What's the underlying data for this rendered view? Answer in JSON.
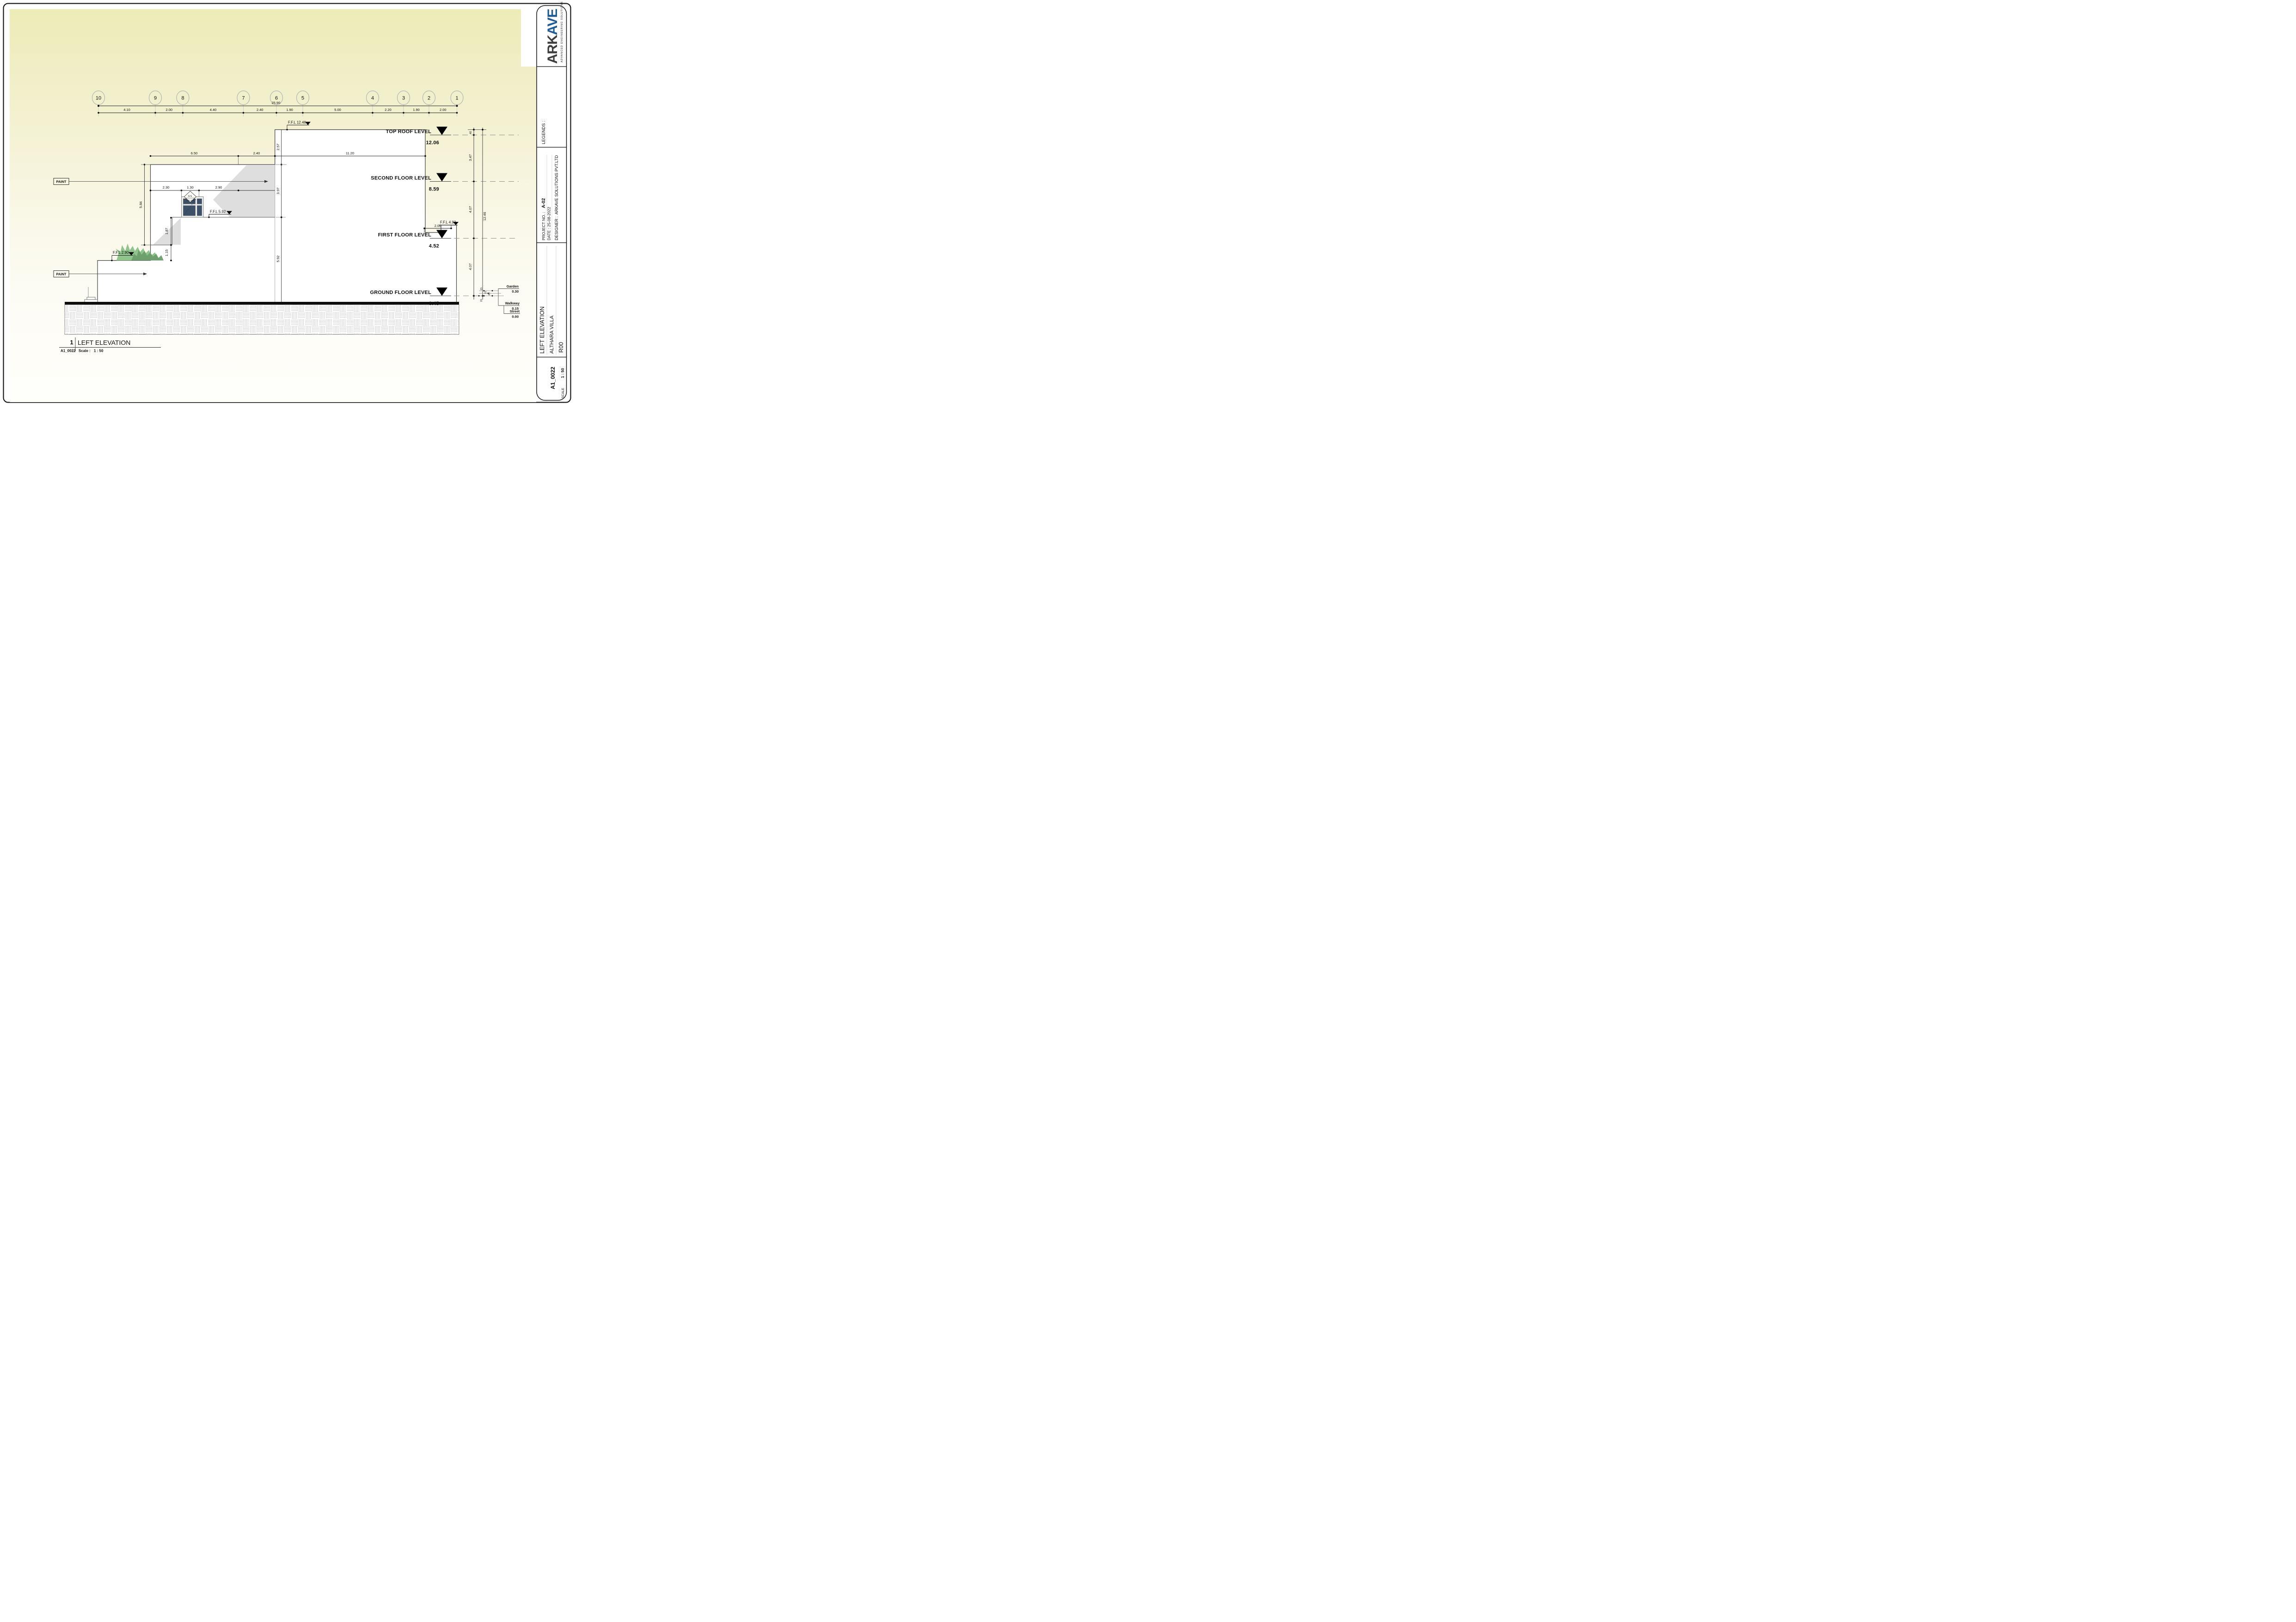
{
  "title_block": {
    "brand_prefix": "ARK",
    "brand_suffix": "AVE",
    "brand_tagline": "ADVANCED ENGINEERING SOLUTIONS",
    "legends_label": "LEGENDS :",
    "project_no_label": "PROJECT NO. :",
    "project_no_value": "A-02",
    "date_label": "DATE : 25-08-2022",
    "designer_label": "DESIGNER :",
    "designer_value": "ARKAVE SOLUTIONS PVT.LTD",
    "drawing_title": "LEFT ELEVATION",
    "project_name": "ALTHARA VILLA",
    "revision": "R00",
    "sheet_no": "A1_0022",
    "scale_label": "SCALE",
    "scale_value": "1 : 50"
  },
  "view_title": {
    "number": "1",
    "title": "LEFT ELEVATION",
    "sheet_ref": "A1_0022",
    "scale_label": "Scale :",
    "scale_value": "1 : 50"
  },
  "grid": {
    "bubbles": [
      "10",
      "9",
      "8",
      "7",
      "6",
      "5",
      "4",
      "3",
      "2",
      "1"
    ],
    "total": "25.90",
    "segments": [
      "4.10",
      "2.00",
      "4.40",
      "2.40",
      "1.90",
      "5.00",
      "2.20",
      "1.90",
      "2.00"
    ]
  },
  "levels": [
    {
      "name": "TOP ROOF LEVEL",
      "value": "12.06"
    },
    {
      "name": "SECOND FLOOR LEVEL",
      "value": "8.59"
    },
    {
      "name": "FIRST FLOOR LEVEL",
      "value": "4.52"
    },
    {
      "name": "GROUND FLOOR LEVEL",
      "value": "0.45"
    }
  ],
  "ffl": {
    "roof": "F.F.L 12.46",
    "second": "F.F.L 5.92",
    "garden": "F.F.L 2.90",
    "first": "F.F.L 4.92"
  },
  "site_levels": [
    {
      "name": "Garden",
      "value": "0.30"
    },
    {
      "name": "Walkway",
      "value": "0.15"
    },
    {
      "name": "Street",
      "value": "0.00"
    }
  ],
  "dims": {
    "roof_left": "6.50",
    "roof_left2": "2.40",
    "roof_main": "11.20",
    "left_height": "5.84",
    "step_height": "1.87",
    "planter_height": "1.15",
    "core_top": "2.57",
    "core_mid": "3.97",
    "core_bottom": "5.92",
    "parapet": "40",
    "roof_to_second": "3.47",
    "second_to_first": "4.07",
    "first_to_ground": "4.07",
    "overall_height": "12.46",
    "door_left": "2.30",
    "door_width": "1.30",
    "door_right": "2.90",
    "ledge_offset": "2.00",
    "site_small": [
      "15",
      "15",
      "45",
      "15"
    ]
  },
  "annotations": {
    "paint": "PAINT",
    "door_tag": "GS",
    "door_size": "1.30 x 3.00"
  },
  "colors": {
    "accent_blue": "#1d5c94",
    "logo_dark": "#3e3e3e",
    "door_panel": "#3c5168",
    "plant_light": "#8fc48c",
    "plant_dark": "#6d9e6d",
    "paper_yellow": "#efedc0",
    "shadow_gray": "#dedede"
  }
}
